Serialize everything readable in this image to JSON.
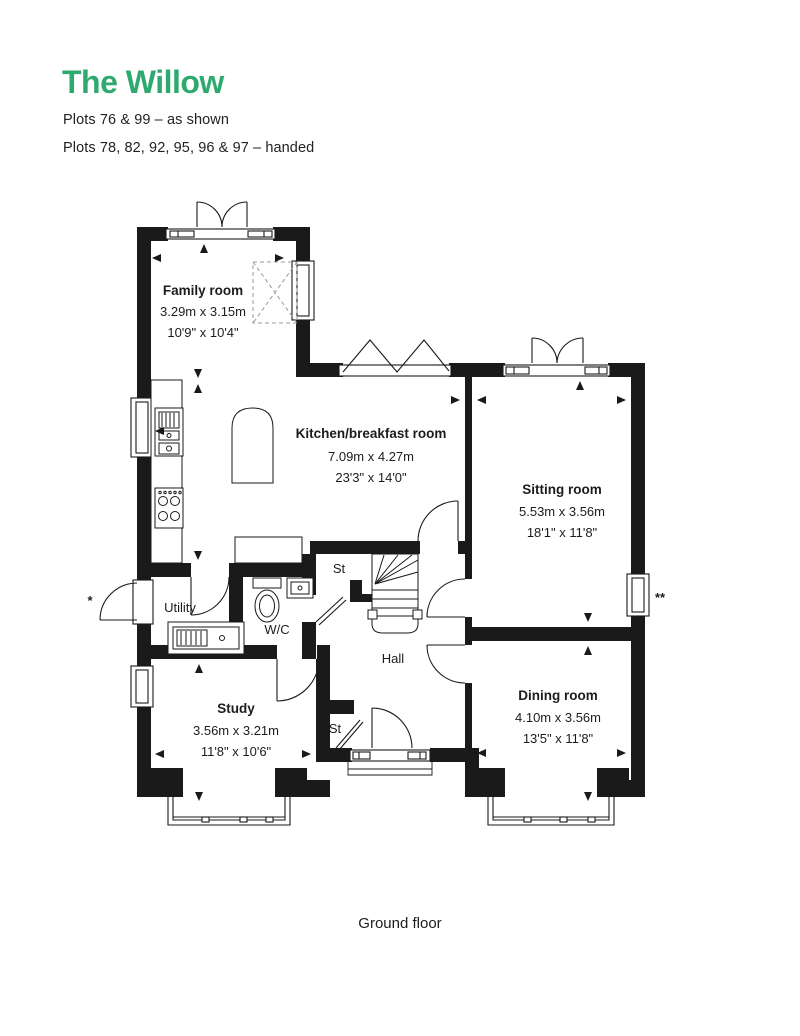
{
  "header": {
    "title": "The Willow",
    "plots_line1": "Plots 76 & 99 – as shown",
    "plots_line2": "Plots 78, 82, 92, 95, 96 & 97 – handed"
  },
  "caption": {
    "floor": "Ground floor"
  },
  "colors": {
    "accent_green": "#2FAA6E",
    "wall_black": "#1A1A1A"
  },
  "rooms": {
    "family": {
      "name": "Family room",
      "metric": "3.29m x 3.15m",
      "imperial": "10'9\" x 10'4\""
    },
    "kitchen": {
      "name": "Kitchen/breakfast room",
      "metric": "7.09m x 4.27m",
      "imperial": "23'3\" x 14'0\""
    },
    "sitting": {
      "name": "Sitting room",
      "metric": "5.53m x 3.56m",
      "imperial": "18'1\" x 11'8\""
    },
    "dining": {
      "name": "Dining room",
      "metric": "4.10m x 3.56m",
      "imperial": "13'5\" x 11'8\""
    },
    "study": {
      "name": "Study",
      "metric": "3.56m x 3.21m",
      "imperial": "11'8\" x 10'6\""
    },
    "utility": {
      "name": "Utility"
    },
    "wc": {
      "name": "W/C"
    },
    "hall": {
      "name": "Hall"
    },
    "store_understairs": {
      "name": "St"
    },
    "store_hall": {
      "name": "St"
    }
  },
  "annotations": {
    "asterisk": "*",
    "double_asterisk": "**"
  }
}
